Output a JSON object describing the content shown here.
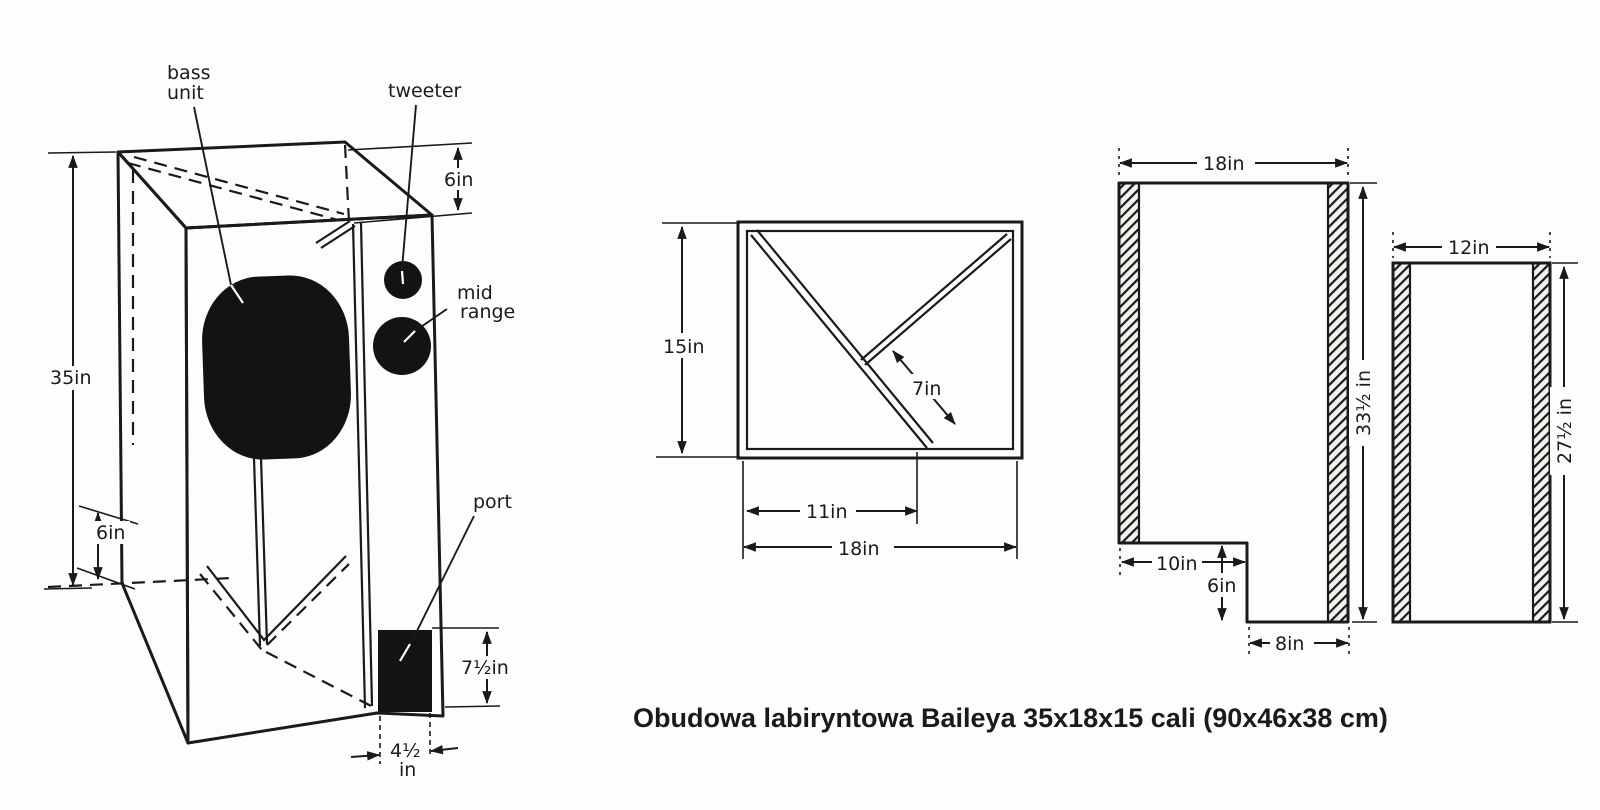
{
  "caption": "Obudowa labiryntowa Baileya 35x18x15 cali (90x46x38 cm)",
  "perspective_view": {
    "labels": {
      "bass_unit_line1": "bass",
      "bass_unit_line2": "unit",
      "tweeter": "tweeter",
      "mid_range_line1": "mid",
      "mid_range_line2": "range",
      "port": "port"
    },
    "dimensions": {
      "height": "35in",
      "top_depth": "6in",
      "bottom_left": "6in",
      "port_height": "7½in",
      "port_width_line1": "4½",
      "port_width_line2": "in"
    }
  },
  "top_view": {
    "dimensions": {
      "depth": "15in",
      "partition_length": "7in",
      "partition_offset": "11in",
      "width": "18in"
    }
  },
  "side_panel": {
    "dimensions": {
      "width": "18in",
      "height": "33½ in",
      "notch_width": "10in",
      "notch_height": "6in",
      "bottom_width": "8in"
    }
  },
  "back_panel": {
    "dimensions": {
      "width": "12in",
      "height": "27½ in"
    }
  },
  "colors": {
    "ink": "#1a1a1a",
    "paper": "#fdfdfc",
    "driver": "#131313"
  }
}
